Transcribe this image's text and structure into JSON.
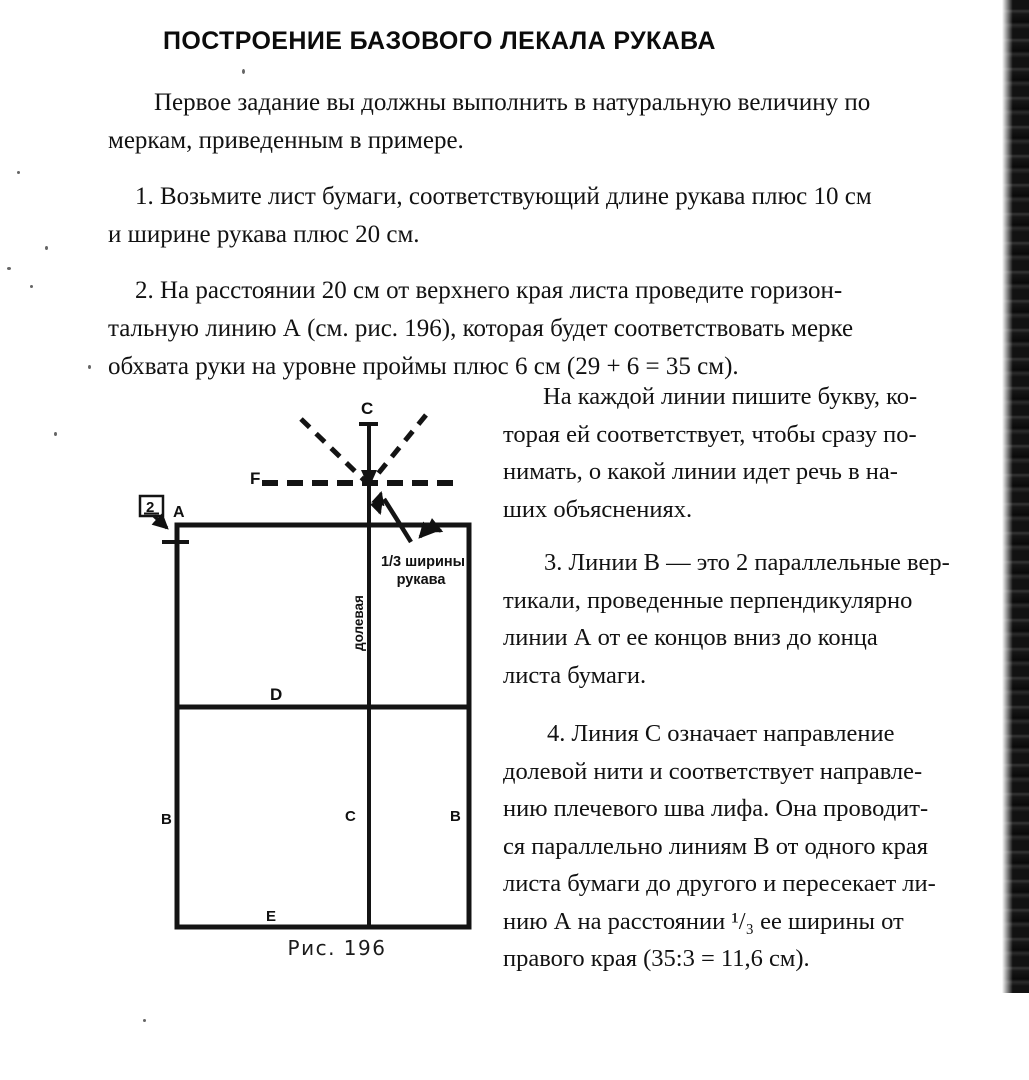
{
  "document": {
    "title": "ПОСТРОЕНИЕ БАЗОВОГО ЛЕКАЛА РУКАВА",
    "paragraphs": {
      "intro": [
        "Первое задание вы должны выполнить в натуральную величину по",
        "меркам, приведенным в примере."
      ],
      "step1": [
        "1. Возьмите лист бумаги, соответствующий длине рукава плюс 10 см",
        "и ширине рукава плюс 20 см."
      ],
      "step2": [
        "2. На расстоянии 20 см от верхнего края листа проведите горизон-",
        "тальную линию А (см. рис. 196), которая будет соответствовать мерке",
        "обхвата руки на уровне проймы плюс 6 см (29 + 6 = 35 см)."
      ],
      "note": [
        "На каждой линии пишите букву, ко-",
        "торая ей соответствует, чтобы сразу по-",
        "нимать, о какой линии идет речь в на-",
        "ших объяснениях."
      ],
      "step3": [
        "3. Линии В — это 2 параллельные вер-",
        "тикали, проведенные перпендикулярно",
        "линии А от ее концов вниз до конца",
        "листа бумаги."
      ],
      "step4": [
        "4. Линия С означает направление",
        "долевой нити и соответствует направле-",
        "нию плечевого шва лифа. Она проводит-",
        "ся параллельно линиям В от одного края",
        "листа бумаги до другого и пересекает ли-",
        "нию А на расстоянии ¹/₃ ее ширины от",
        "правого края (35:3 = 11,6 см)."
      ]
    },
    "figure": {
      "caption": "Рис. 196",
      "labels": {
        "grain_top": "C",
        "fold": "F",
        "corner": "A",
        "elbow": "D",
        "side_left": "B",
        "grain_mid": "C",
        "side_right": "B",
        "bottom": "E",
        "piece_number": "2",
        "grain_text": "долевая",
        "third_width_1": "1/3 ширины",
        "third_width_2": "рукава"
      }
    },
    "colors": {
      "ink": "#111111",
      "paper": "#ffffff",
      "scan_band": "#1d1d1d"
    }
  }
}
